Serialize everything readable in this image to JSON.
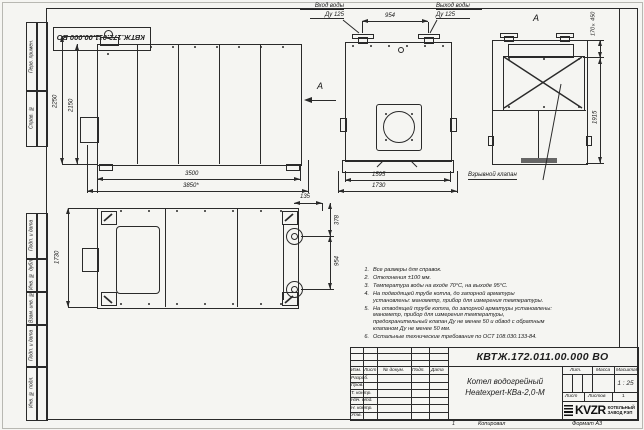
{
  "colors": {
    "paper": "#f5f5f2",
    "ink": "#2a2a2a"
  },
  "doc": {
    "number": "КВТЖ.172.011.00.000 ВО"
  },
  "frame": {
    "left_cells_top": [
      "Перв. примен.",
      "Справ. №"
    ],
    "left_cells_bottom": [
      "Подп. и дата",
      "Инв. № дубл.",
      "Взам. инв. №",
      "Подп. и дата",
      "Инв. № подл."
    ]
  },
  "labels": {
    "view_arrow": "А",
    "view_a_title": "А",
    "inlet_line1": "Вход воды",
    "inlet_line2": "Ду 125",
    "outlet_line1": "Выход воды",
    "outlet_line2": "Ду 125",
    "explosion_valve": "Взрывной клапан"
  },
  "dims": {
    "side_height_full": "2250",
    "side_height_body": "2150",
    "side_length_body": "3500",
    "side_length_full": "3850*",
    "front_nozzles": "954",
    "front_width_body": "1595",
    "front_width_full": "1730",
    "viewa_valve_size": "170×450",
    "viewa_height": "1915",
    "top_depth": "1730",
    "top_offset": "135",
    "top_pitch1": "378",
    "top_pitch2": "954"
  },
  "notes": [
    {
      "num": "1.",
      "text": "Все размеры для справок."
    },
    {
      "num": "2.",
      "text": "Отклонения ±100 мм."
    },
    {
      "num": "3.",
      "text": "Температура воды на входе 70°С, на выходе 95°С."
    },
    {
      "num": "4.",
      "text": "На подводящей трубе котла, до запорной арматуры установлены: манометр, прибор для измерения температуры."
    },
    {
      "num": "5.",
      "text": "На отводящей трубе котла, до запорной арматуры установлены: манометр, прибор для измерения температуры, предохранительный клапан Ду не менее 50 и обвод с обратным клапаном Ду не менее 50 мм."
    },
    {
      "num": "6.",
      "text": "Остальные технические требования по ОСТ 108.030.133-84."
    }
  ],
  "title_block": {
    "doc_number": "КВТЖ.172.011.00.000 ВО",
    "col_izm": "Изм.",
    "col_list": "Лист",
    "col_docnum": "№ докум.",
    "col_podp": "Подп.",
    "col_data": "Дата",
    "row_razrab": "Разраб.",
    "row_prov": "Пров.",
    "row_tkontr": "Т. контр.",
    "row_nachotd": "Нач. отд.",
    "row_nkontr": "Н. контр.",
    "row_utv": "Утв.",
    "product_line1": "Котел водогрейный",
    "product_line2": "Heatexpert-КВа-2,0-М",
    "lit": "Лит.",
    "mass": "Масса",
    "scale": "Масштаб",
    "scale_value": "1 : 25",
    "sheet": "Лист",
    "sheets": "Листов",
    "sheets_value": "1",
    "logo": "KVZR",
    "logo_line1": "КОТЕЛЬНЫЙ",
    "logo_line2": "ЗАВОД РЭП"
  },
  "footer": {
    "sheet_no": "1",
    "copy": "Копировал",
    "format": "Формат А3"
  }
}
